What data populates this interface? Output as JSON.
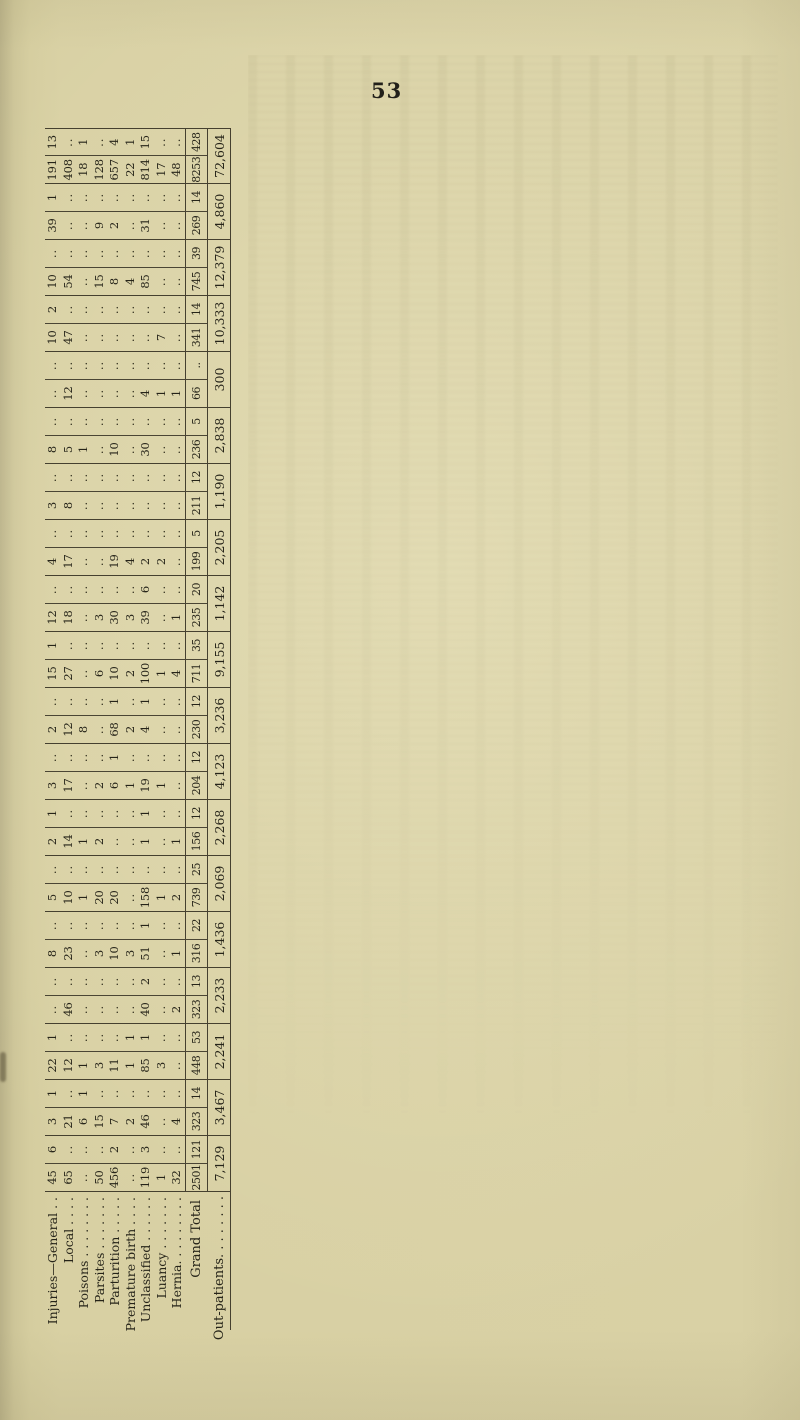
{
  "page": {
    "number": "53"
  },
  "paper": {
    "background": "#d8d0a3",
    "ink": "#262419",
    "rule": "#45402f"
  },
  "table": {
    "categories": [
      "Injuries—General",
      "Local",
      "Poisons",
      "Parsites",
      "Parturition",
      "Premature birth",
      "Unclassified",
      "Luancy",
      "Hernia"
    ],
    "row_labels_display": [
      "Injuries—General . .",
      "Local . . . .",
      "Poisons . . . . . . . .",
      "Parsites . . . . . . .",
      "Parturition . . . . .",
      "Premature birth . . . .",
      "Unclassified . . . . . .",
      "Luancy . . . . . . .",
      "Hernia. . . . . . . . ."
    ],
    "grand_total_label": "Grand Total",
    "out_patients_label": "Out-patients. . . . . . . .",
    "empty_cell_mark": "..",
    "pairs": [
      {
        "columns": [
          {
            "values": [
              "45",
              "65",
              "..",
              "50",
              "456",
              "..",
              "119",
              "1",
              "32"
            ],
            "grand_total": "2501"
          },
          {
            "values": [
              "6",
              "..",
              "..",
              "..",
              "2",
              "..",
              "3",
              "..",
              ".."
            ],
            "grand_total": "121"
          }
        ],
        "out_patients": "7,129"
      },
      {
        "columns": [
          {
            "values": [
              "3",
              "21",
              "6",
              "15",
              "7",
              "2",
              "46",
              "..",
              "4"
            ],
            "grand_total": "323"
          },
          {
            "values": [
              "1",
              "..",
              "1",
              "..",
              "..",
              "..",
              "..",
              "..",
              ".."
            ],
            "grand_total": "14"
          }
        ],
        "out_patients": "3,467"
      },
      {
        "columns": [
          {
            "values": [
              "22",
              "12",
              "1",
              "3",
              "11",
              "1",
              "85",
              "3",
              ".."
            ],
            "grand_total": "448"
          },
          {
            "values": [
              "1",
              "..",
              "..",
              "..",
              "..",
              "1",
              "1",
              "..",
              ".."
            ],
            "grand_total": "53"
          }
        ],
        "out_patients": "2,241"
      },
      {
        "columns": [
          {
            "values": [
              "..",
              "46",
              "..",
              "..",
              "..",
              "..",
              "40",
              "..",
              "2"
            ],
            "grand_total": "323"
          },
          {
            "values": [
              "..",
              "..",
              "..",
              "..",
              "..",
              "..",
              "2",
              "..",
              ".."
            ],
            "grand_total": "13"
          }
        ],
        "out_patients": "2,233"
      },
      {
        "columns": [
          {
            "values": [
              "8",
              "23",
              "..",
              "3",
              "10",
              "3",
              "51",
              "..",
              "1"
            ],
            "grand_total": "316"
          },
          {
            "values": [
              "..",
              "..",
              "..",
              "..",
              "..",
              "..",
              "1",
              "..",
              ".."
            ],
            "grand_total": "22"
          }
        ],
        "out_patients": "1,436"
      },
      {
        "columns": [
          {
            "values": [
              "5",
              "10",
              "1",
              "20",
              "20",
              "..",
              "158",
              "1",
              "2"
            ],
            "grand_total": "739"
          },
          {
            "values": [
              "..",
              "..",
              "..",
              "..",
              "..",
              "..",
              "..",
              "..",
              ".."
            ],
            "grand_total": "25"
          }
        ],
        "out_patients": "2,069"
      },
      {
        "columns": [
          {
            "values": [
              "2",
              "14",
              "1",
              "2",
              "..",
              "..",
              "1",
              "..",
              "1"
            ],
            "grand_total": "156"
          },
          {
            "values": [
              "1",
              "..",
              "..",
              "..",
              "..",
              "..",
              "1",
              "..",
              ".."
            ],
            "grand_total": "12"
          }
        ],
        "out_patients": "2,268"
      },
      {
        "columns": [
          {
            "values": [
              "3",
              "17",
              "..",
              "2",
              "6",
              "1",
              "19",
              "1",
              ".."
            ],
            "grand_total": "204"
          },
          {
            "values": [
              "..",
              "..",
              "..",
              "..",
              "1",
              "..",
              "..",
              "..",
              ".."
            ],
            "grand_total": "12"
          }
        ],
        "out_patients": "4,123"
      },
      {
        "columns": [
          {
            "values": [
              "2",
              "12",
              "8",
              "..",
              "68",
              "2",
              "4",
              "..",
              ".."
            ],
            "grand_total": "230"
          },
          {
            "values": [
              "..",
              "..",
              "..",
              "..",
              "1",
              "..",
              "1",
              "..",
              ".."
            ],
            "grand_total": "12"
          }
        ],
        "out_patients": "3,236"
      },
      {
        "columns": [
          {
            "values": [
              "15",
              "27",
              "..",
              "6",
              "10",
              "2",
              "100",
              "1",
              "4"
            ],
            "grand_total": "711"
          },
          {
            "values": [
              "1",
              "..",
              "..",
              "..",
              "..",
              "..",
              "..",
              "..",
              ".."
            ],
            "grand_total": "35"
          }
        ],
        "out_patients": "9,155"
      },
      {
        "columns": [
          {
            "values": [
              "12",
              "18",
              "..",
              "3",
              "30",
              "3",
              "39",
              "..",
              "1"
            ],
            "grand_total": "235"
          },
          {
            "values": [
              "..",
              "..",
              "..",
              "..",
              "..",
              "..",
              "6",
              "..",
              ".."
            ],
            "grand_total": "20"
          }
        ],
        "out_patients": "1,142"
      },
      {
        "columns": [
          {
            "values": [
              "4",
              "17",
              "..",
              "..",
              "19",
              "4",
              "2",
              "2",
              ".."
            ],
            "grand_total": "199"
          },
          {
            "values": [
              "..",
              "..",
              "..",
              "..",
              "..",
              "..",
              "..",
              "..",
              ".."
            ],
            "grand_total": "5"
          }
        ],
        "out_patients": "2,205"
      },
      {
        "columns": [
          {
            "values": [
              "3",
              "8",
              "..",
              "..",
              "..",
              "..",
              "..",
              "..",
              ".."
            ],
            "grand_total": "211"
          },
          {
            "values": [
              "..",
              "..",
              "..",
              "..",
              "..",
              "..",
              "..",
              "..",
              ".."
            ],
            "grand_total": "12"
          }
        ],
        "out_patients": "1,190"
      },
      {
        "columns": [
          {
            "values": [
              "8",
              "5",
              "1",
              "..",
              "10",
              "..",
              "30",
              "..",
              ".."
            ],
            "grand_total": "236"
          },
          {
            "values": [
              "..",
              "..",
              "..",
              "..",
              "..",
              "..",
              "..",
              "..",
              ".."
            ],
            "grand_total": "5"
          }
        ],
        "out_patients": "2,838"
      },
      {
        "columns": [
          {
            "values": [
              "..",
              "12",
              "..",
              "..",
              "..",
              "..",
              "4",
              "1",
              "1"
            ],
            "grand_total": "66"
          },
          {
            "values": [
              "..",
              "..",
              "..",
              "..",
              "..",
              "..",
              "..",
              "..",
              ".."
            ],
            "grand_total": ".."
          }
        ],
        "out_patients": "300"
      },
      {
        "columns": [
          {
            "values": [
              "10",
              "47",
              "..",
              "..",
              "..",
              "..",
              "..",
              "7",
              ".."
            ],
            "grand_total": "341"
          },
          {
            "values": [
              "2",
              "..",
              "..",
              "..",
              "..",
              "..",
              "..",
              "..",
              ".."
            ],
            "grand_total": "14"
          }
        ],
        "out_patients": "10,333"
      },
      {
        "columns": [
          {
            "values": [
              "10",
              "54",
              "..",
              "15",
              "8",
              "4",
              "85",
              "..",
              ".."
            ],
            "grand_total": "745"
          },
          {
            "values": [
              "..",
              "..",
              "..",
              "..",
              "..",
              "..",
              "..",
              "..",
              ".."
            ],
            "grand_total": "39"
          }
        ],
        "out_patients": "12,379"
      },
      {
        "columns": [
          {
            "values": [
              "39",
              "..",
              "..",
              "9",
              "2",
              "..",
              "31",
              "..",
              ".."
            ],
            "grand_total": "269"
          },
          {
            "values": [
              "1",
              "..",
              "..",
              "..",
              "..",
              "..",
              "..",
              "..",
              ".."
            ],
            "grand_total": "14"
          }
        ],
        "out_patients": "4,860"
      },
      {
        "columns": [
          {
            "values": [
              "191",
              "408",
              "18",
              "128",
              "657",
              "22",
              "814",
              "17",
              "48"
            ],
            "grand_total": "8253"
          },
          {
            "values": [
              "13",
              "..",
              "1",
              "..",
              "4",
              "1",
              "15",
              "..",
              ".."
            ],
            "grand_total": "428"
          }
        ],
        "out_patients": "72,604"
      }
    ]
  }
}
